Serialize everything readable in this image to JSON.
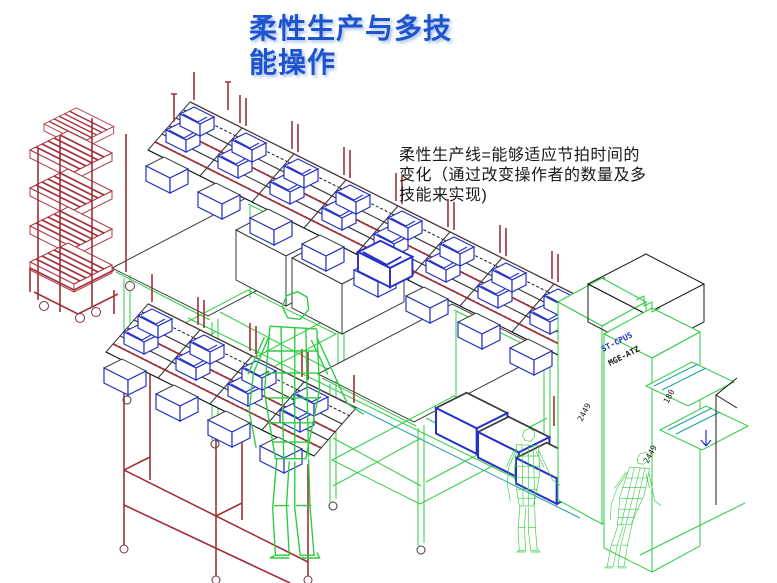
{
  "slide": {
    "title": {
      "line1": "柔性生产与多技",
      "line2": "能操作"
    },
    "body": {
      "line1": "柔性生产线=能够适应节拍时间的",
      "line2": "变化（通过改变操作者的数量及多",
      "line3": "技能来实现)"
    }
  },
  "diagram": {
    "machine_labels": {
      "blue": "ST-CPUS",
      "black": "MGE-ATZ"
    },
    "dimensions": {
      "dim1": "2449",
      "dim2": "180",
      "dim3": "2449"
    },
    "colors": {
      "title_blue": "#1d53cc",
      "cad_red": "#a03038",
      "cad_green": "#2ecc40",
      "cad_blue": "#2531c8",
      "cad_black": "#1a1a1a",
      "cad_teal": "#18a0a0",
      "background": "#ffffff"
    }
  }
}
